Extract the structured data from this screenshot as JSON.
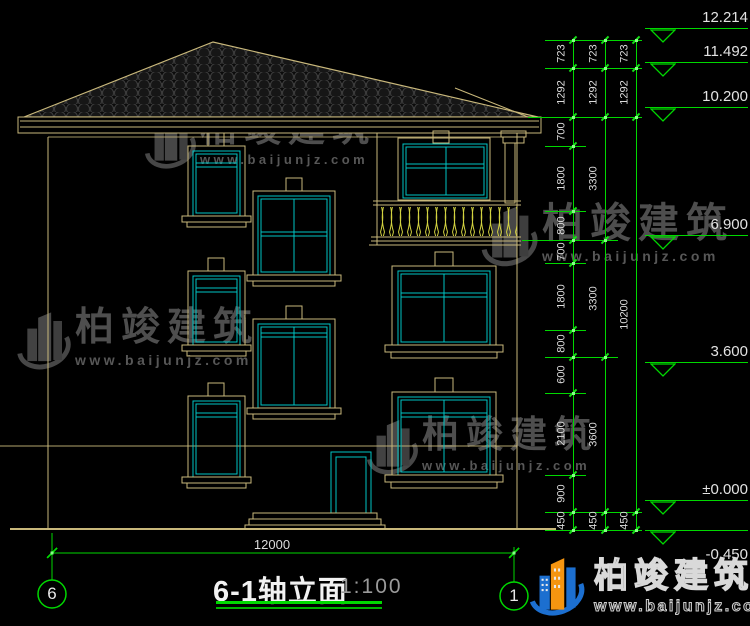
{
  "title": {
    "text": "6-1轴立面",
    "scale": "1:100"
  },
  "axes": {
    "left": "6",
    "right": "1",
    "span_dimension": "12000"
  },
  "drawing": {
    "elevation_markers": [
      {
        "label": "12.214",
        "y": 28
      },
      {
        "label": "11.492",
        "y": 62
      },
      {
        "label": "10.200",
        "y": 107
      },
      {
        "label": "6.900",
        "y": 235
      },
      {
        "label": "3.600",
        "y": 362
      },
      {
        "label": "±0.000",
        "y": 500
      },
      {
        "label": "-0.450",
        "y": 530,
        "below": true
      }
    ],
    "dimension_chains": [
      {
        "x": 573,
        "segments": [
          [
            "723",
            40,
            68
          ],
          [
            "1292",
            68,
            117
          ],
          [
            "700",
            117,
            146
          ],
          [
            "1800",
            146,
            211
          ],
          [
            "800",
            211,
            240
          ],
          [
            "700",
            240,
            263
          ],
          [
            "1800",
            263,
            330
          ],
          [
            "800",
            330,
            357
          ],
          [
            "600",
            357,
            393
          ],
          [
            "2100",
            393,
            475
          ],
          [
            "900",
            475,
            512
          ],
          [
            "450",
            512,
            530
          ]
        ]
      },
      {
        "x": 605,
        "segments": [
          [
            "723",
            40,
            68
          ],
          [
            "1292",
            68,
            117
          ],
          [
            "3300",
            117,
            240
          ],
          [
            "3300",
            240,
            357
          ],
          [
            "3600",
            357,
            512
          ],
          [
            "450",
            512,
            530
          ]
        ]
      },
      {
        "x": 636,
        "segments": [
          [
            "723",
            40,
            68
          ],
          [
            "1292",
            68,
            117
          ],
          [
            "10200",
            117,
            512
          ],
          [
            "450",
            512,
            530
          ]
        ]
      }
    ],
    "connectors": [
      [
        40,
        545,
        642
      ],
      [
        68,
        545,
        642
      ],
      [
        117,
        528,
        642
      ],
      [
        146,
        545,
        586
      ],
      [
        211,
        545,
        586
      ],
      [
        240,
        522,
        618
      ],
      [
        263,
        545,
        586
      ],
      [
        330,
        545,
        586
      ],
      [
        357,
        545,
        618
      ],
      [
        393,
        545,
        586
      ],
      [
        475,
        545,
        586
      ],
      [
        512,
        545,
        642
      ],
      [
        530,
        545,
        642
      ]
    ]
  },
  "watermarks": {
    "brand": "柏竣建筑",
    "site": "www.baijunjz.com",
    "instances": [
      {
        "x": 138,
        "y": 110,
        "s": 1.0
      },
      {
        "x": 474,
        "y": 202,
        "s": 1.1
      },
      {
        "x": 10,
        "y": 308,
        "s": 1.05
      },
      {
        "x": 360,
        "y": 416,
        "s": 1.0
      }
    ]
  },
  "logo": {
    "brand": "柏竣建筑",
    "site": "www.baijunjz.com"
  },
  "colors": {
    "line_tan": "#c9b87b",
    "window_cyan": "#00c5c5",
    "dim_green": "#00d800",
    "baluster_yellow": "#d2d240",
    "text_white": "#e2e2e2",
    "watermark_gray": "#4e4e4e",
    "logo_blue": "#1c6fd0",
    "logo_orange": "#f59510"
  }
}
